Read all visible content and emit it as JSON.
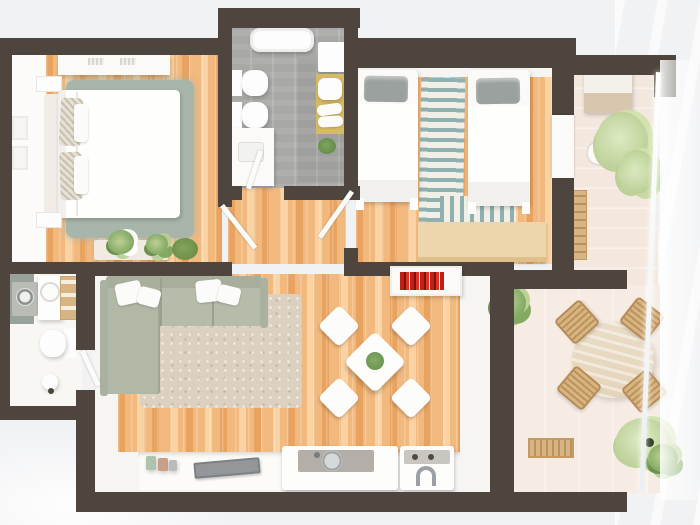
{
  "palette": {
    "bg": "#f1f2f4",
    "wall": "#4e463e",
    "white": "#fdfdfd",
    "wood": "#f2b97e",
    "wood_light": "#f9d3a4",
    "wood_dark": "#e8a360",
    "tile": "#a8a9a6",
    "balcony": "#f3e7de",
    "terrace": "#f6ece4",
    "sofa": "#b6bcaa",
    "sofa_dark": "#a7ae9b",
    "rug_living": "#dcd1c0",
    "rug_bedroom": "#a8b5ab",
    "stripe": "#8fb0b1",
    "stripe_bg": "#f2efe7",
    "red": "#c21f16",
    "plant": "#7aa558",
    "plant_light": "#b9cf92",
    "plant_dark": "#5f8a44",
    "wood_furn": "#d7b484",
    "wood_furn_dark": "#bd9258",
    "mat": "#d6bb66",
    "gray_fixture": "#b3afa8",
    "steel": "#c5c9cb",
    "pillow_gray": "#9aa19f",
    "desk": "#eed6ac",
    "tan": "#d9c6ae"
  },
  "scene": {
    "type": "floor-plan",
    "view": "3d-top-down-render",
    "rooms": [
      {
        "id": "bedroom-1",
        "label": "master bedroom",
        "furniture": [
          "wardrobe",
          "double-bed",
          "patterned-pillows",
          "two-nightstands",
          "sage-rug",
          "console-with-plants",
          "two-wall-frames"
        ]
      },
      {
        "id": "bathroom",
        "label": "bathroom",
        "furniture": [
          "bathtub",
          "wall-hung-toilet",
          "bidet",
          "vanity-sink",
          "stool",
          "rolled-towels",
          "yellow-mat",
          "small-plant"
        ]
      },
      {
        "id": "bedroom-2",
        "label": "twin bedroom",
        "furniture": [
          "single-bed-left",
          "single-bed-right",
          "gray-pillows",
          "striped-runner-rug",
          "wood-dresser",
          "door-to-balcony"
        ]
      },
      {
        "id": "balcony",
        "label": "balcony",
        "furniture": [
          "cabinet",
          "potted-plant",
          "slat-bench",
          "glass-railing"
        ]
      },
      {
        "id": "wc",
        "label": "guest wc",
        "furniture": [
          "washing-machine",
          "round-basin",
          "wood-rack",
          "toilet",
          "small-fixture"
        ]
      },
      {
        "id": "living-room",
        "label": "open living room with kitchen",
        "furniture": [
          "sage-corner-sofa",
          "white-cushions",
          "beige-rug",
          "square-dining-table",
          "four-white-chairs",
          "centerpiece-plant",
          "shelf-with-red-books",
          "kitchen-counter",
          "canisters",
          "gray-tray",
          "sink-island",
          "cooktop-with-faucet"
        ]
      },
      {
        "id": "terrace",
        "label": "terrace",
        "furniture": [
          "round-outdoor-table",
          "four-rattan-chairs",
          "slat-bench",
          "corner-plants",
          "glass-railing"
        ]
      }
    ]
  }
}
